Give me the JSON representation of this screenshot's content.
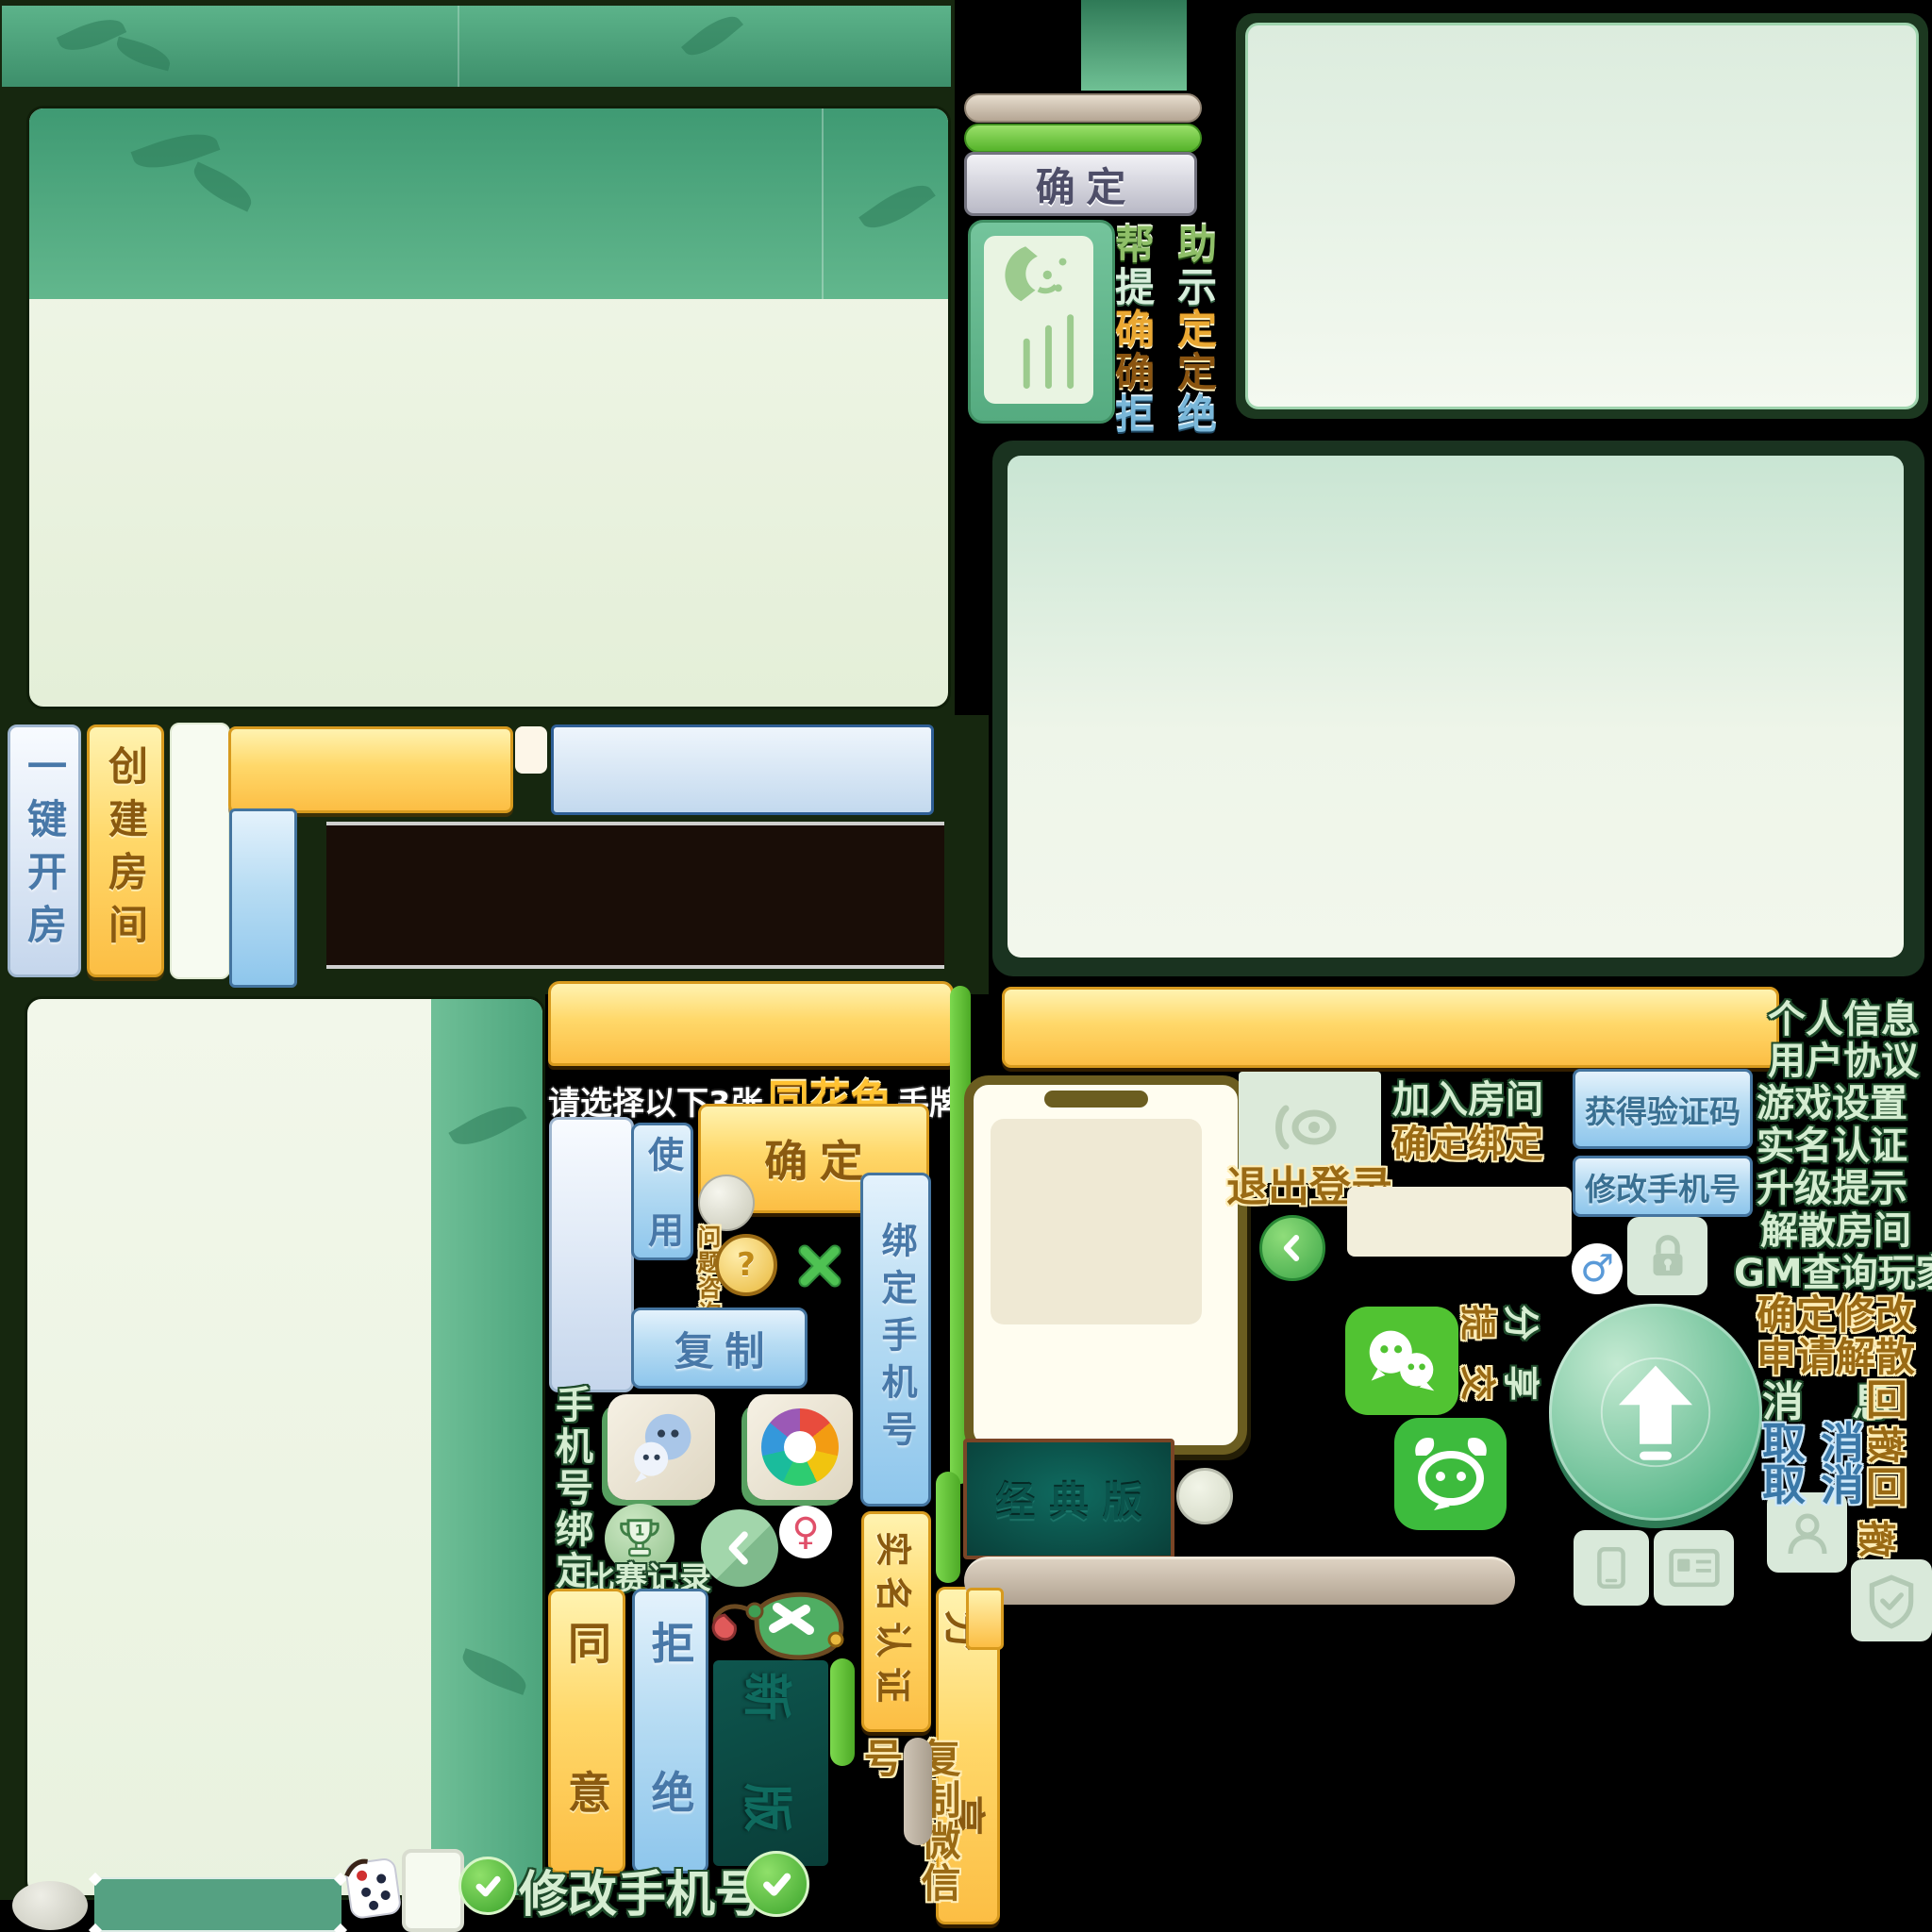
{
  "colors": {
    "background": "#000000",
    "dark_green_field": "#16270f",
    "banner_green": "#49a27c",
    "panel_body": "#edf5e6",
    "panel_header_green": "#4fa980",
    "yellow_button": "#ffd86a",
    "blue_button": "#a9d4ee",
    "gray_button": "#c9c9d2",
    "mint_text": "#d5edd1",
    "gold_text": "#9a6a14",
    "steel_text": "#4878a8",
    "wechat_green": "#51c332",
    "bull_green": "#3dbb3d",
    "classic_teal": "#0c5a52",
    "tan_pill": "#c8bcab",
    "green_pill": "#5cc83a",
    "check_green": "#4abf3a"
  },
  "top_widget": {
    "confirm": "确 定",
    "pairs": [
      {
        "l": "帮",
        "r": "助"
      },
      {
        "l": "提",
        "r": "示"
      },
      {
        "l": "确",
        "r": "定"
      },
      {
        "l": "确",
        "r": "定"
      },
      {
        "l": "拒",
        "r": "绝"
      }
    ],
    "pair_colors": [
      "#8fbf68",
      "#d8eedc",
      "#eaa832",
      "#8a5410",
      "#79b7d9"
    ]
  },
  "left": {
    "one_key_room": "一键开房",
    "create_room": "创建房间"
  },
  "mid": {
    "tip_prefix": "请选择以下3张",
    "tip_highlight": "同花色",
    "tip_suffix": "手牌",
    "confirm": "确 定",
    "use": "使 用",
    "question": "问题咨询",
    "question_mark": "?",
    "copy": "复 制",
    "bind_phone": "绑定手机号",
    "phone_bind": "手机号绑定",
    "trophy_number": "1",
    "match_record": "比赛记录",
    "agree": "同 意",
    "refuse": "拒 绝",
    "new_version": "新 版",
    "realname": "实名认证",
    "share": "分 享",
    "copy_wechat": "复制微信号"
  },
  "right": {
    "classic": "经 典 版",
    "join_room": "加入房间",
    "confirm_bind": "确定绑定",
    "logout": "退出登录",
    "get_code": "获得验证码",
    "modify_phone": "修改手机号",
    "submit": "提交",
    "share": "分享",
    "menu": [
      "个人信息",
      "用户协议",
      "游戏设置",
      "实名认证",
      "升级提示",
      "解散房间",
      "GM查询玩家"
    ],
    "confirm_modify": "确定修改",
    "apply_dissolve": "申请解散",
    "message": "消 息",
    "recall_hui": "回",
    "recall_che": "撤",
    "cancel_qu": "取",
    "cancel_xiao": "消"
  },
  "bottom": {
    "modify_phone": "修改手机号"
  }
}
